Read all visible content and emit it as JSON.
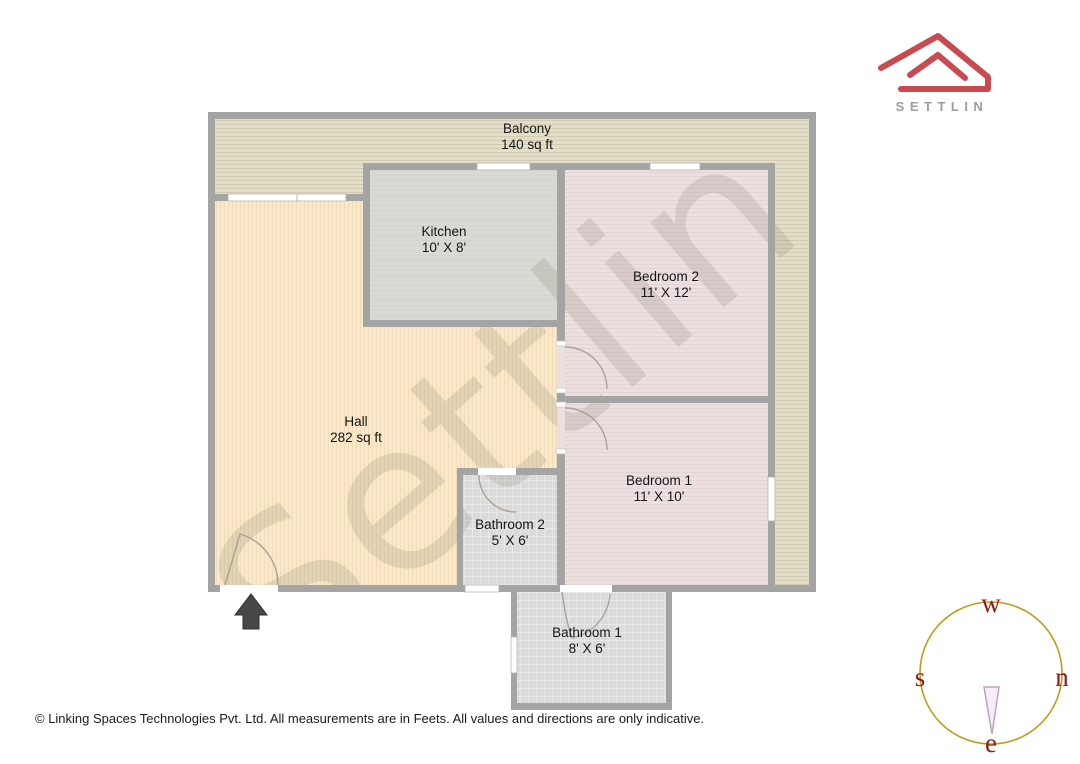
{
  "logo": {
    "brand": "SETTLIN"
  },
  "watermark": {
    "text": "Settlin"
  },
  "rooms": {
    "balcony": {
      "name": "Balcony",
      "size": "140 sq ft"
    },
    "kitchen": {
      "name": "Kitchen",
      "size": "10' X 8'"
    },
    "bedroom2": {
      "name": "Bedroom 2",
      "size": "11' X 12'"
    },
    "hall": {
      "name": "Hall",
      "size": "282 sq ft"
    },
    "bedroom1": {
      "name": "Bedroom 1",
      "size": "11' X 10'"
    },
    "bathroom2": {
      "name": "Bathroom 2",
      "size": "5' X 6'"
    },
    "bathroom1": {
      "name": "Bathroom 1",
      "size": "8' X 6'"
    }
  },
  "compass": {
    "top": "w",
    "left": "s",
    "right": "n",
    "bottom": "e"
  },
  "footer": {
    "copyright": "© Linking Spaces Technologies Pvt. Ltd. All measurements are in Feets. All values and directions are only indicative."
  },
  "colors": {
    "brand_red": "#c84b51",
    "brand_gray": "#9d9d9d",
    "wall_gray": "#a4a4a4",
    "balcony_fill": "#e3decb",
    "hall_fill": "#f9e8cb",
    "kitchen_fill": "#d8dad3",
    "bedroom_fill": "#ebdfdf",
    "bathroom_fill": "#dbdbdb",
    "compass_ring": "#c29a1a",
    "compass_letters": "#8e1a1a",
    "needle_outline": "#bfa3bf"
  }
}
